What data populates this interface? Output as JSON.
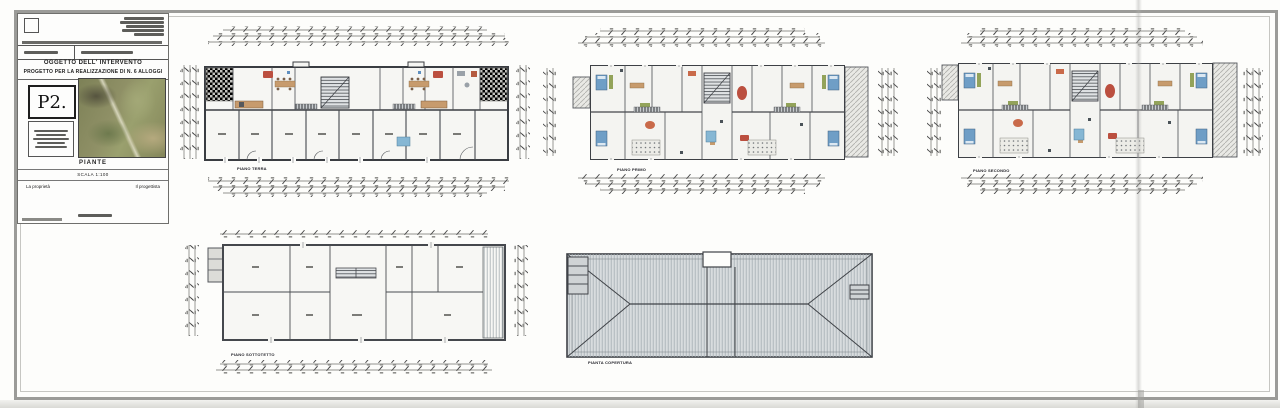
{
  "title_block": {
    "sheet_code": "P2.",
    "section_header": "OGGETTO DELL' INTERVENTO",
    "project_title": "PROGETTO PER LA REALIZZAZIONE DI N. 6 ALLOGGI",
    "drawing_title": "PIANTE",
    "scale_label": "SCALA 1:100",
    "signature_left": "La proprietà",
    "signature_right": "Il progettista"
  },
  "plans": [
    {
      "label": "PIANO TERRA"
    },
    {
      "label": "PIANO PRIMO"
    },
    {
      "label": "PIANO SECONDO"
    },
    {
      "label": "PIANO SOTTOTETTO"
    },
    {
      "label": "PIANTA COPERTURA"
    }
  ],
  "colors": {
    "paper": "#fdfdfb",
    "frame": "#9b9b98",
    "wall": "#3d4045",
    "furniture_red": "#bb4f3f",
    "furniture_orange": "#c96a4a",
    "furniture_tan": "#c79b6d",
    "furniture_green": "#93a35a",
    "furniture_blue": "#6f9ec6",
    "roof_fill": "#d8dcde"
  }
}
